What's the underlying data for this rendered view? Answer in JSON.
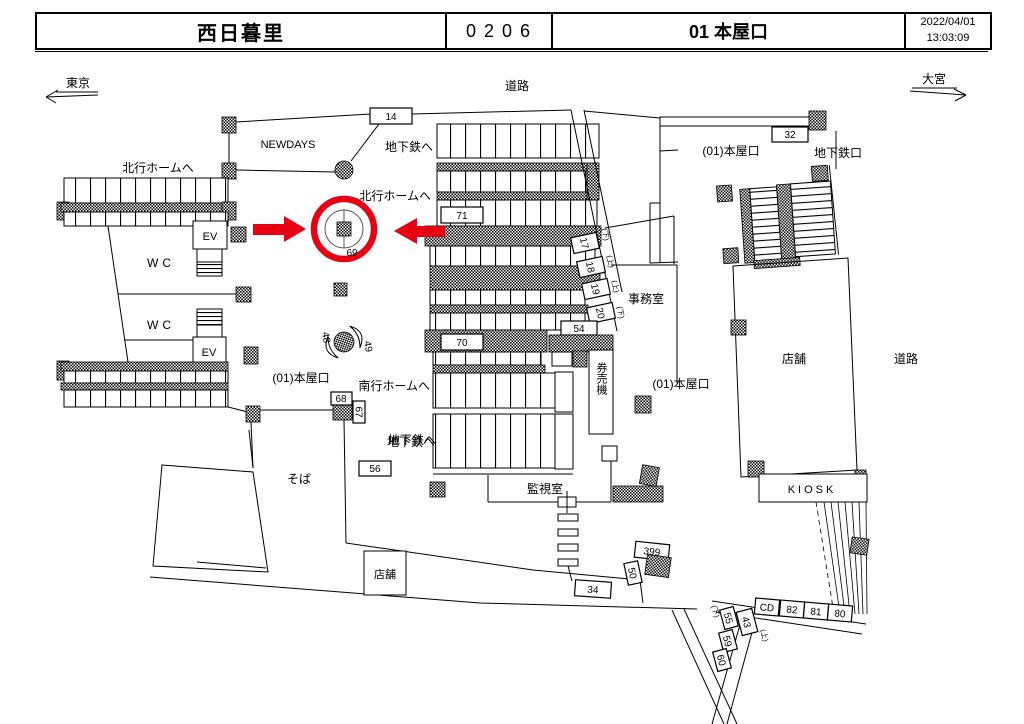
{
  "header": {
    "station": "西日暮里",
    "code": "0206",
    "gate": "01 本屋口",
    "date": "2022/04/01",
    "time": "13:03:09"
  },
  "compass": {
    "west": "東京",
    "east": "大宮"
  },
  "areas": {
    "road": "道路",
    "newdays": "NEWDAYS",
    "to_subway": "地下鉄へ",
    "to_north_platform": "北行ホームへ",
    "to_south_platform": "南行ホームへ",
    "subway_gate": "地下鉄口",
    "main_gate": "(01)本屋口",
    "office": "事務室",
    "ticket_machines": "券売機",
    "monitor_room": "監視室",
    "soba": "そば",
    "shop": "店舗",
    "kiosk": "KIOSK",
    "wc": "WC",
    "ev": "EV"
  },
  "markers": {
    "n14": "14",
    "n32": "32",
    "n71": "71",
    "n70": "70",
    "n54": "54",
    "n17": "17",
    "n18": "18",
    "n19": "19",
    "n20": "20",
    "n68": "68",
    "n67": "67",
    "n69": "69",
    "n48": "48",
    "n49": "49",
    "n56": "56",
    "n34": "34",
    "n399": "399",
    "n50": "50",
    "cd": "CD",
    "n82": "82",
    "n81": "81",
    "n80": "80",
    "n55": "55",
    "n43": "43",
    "n59": "59",
    "n60": "60",
    "up": "(上)",
    "down": "(下)"
  },
  "colors": {
    "highlight": "#e60012",
    "ink": "#000000"
  }
}
